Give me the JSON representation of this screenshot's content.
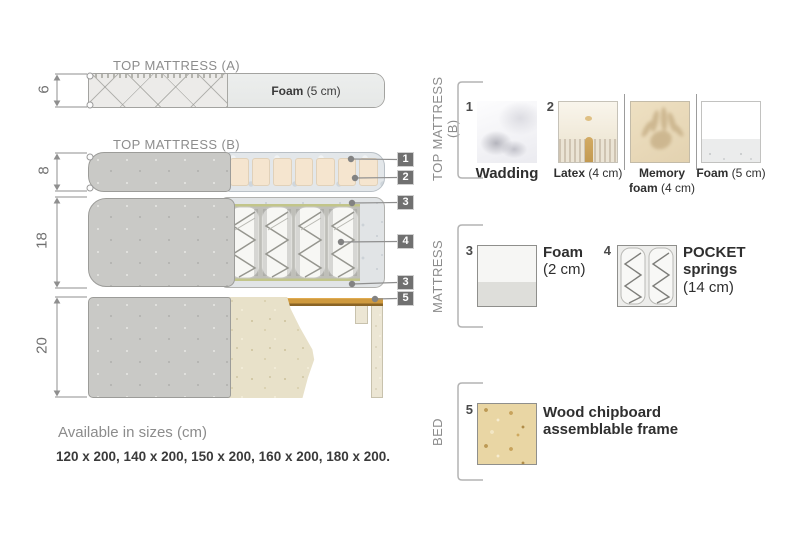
{
  "colors": {
    "badge_bg": "#707070",
    "wood_accent": "#cf9a3f",
    "text_dark": "#3a3a3a",
    "text_gray": "#8c8c8c",
    "cover_gray": "#c9c9c6",
    "bed_beige": "#e8e1c9",
    "block_cream": "#f5e5cf"
  },
  "diagram": {
    "top_mattress_a_title": "TOP MATTRESS (A)",
    "top_mattress_b_title": "TOP MATTRESS (B)",
    "foam_a": {
      "bold": "Foam",
      "rest": " (5 cm)"
    },
    "dims": [
      "6",
      "8",
      "18",
      "20"
    ],
    "badges": [
      "1",
      "2",
      "3",
      "4",
      "3",
      "5"
    ]
  },
  "legend": {
    "row1": {
      "section_label": "TOP MATTRESS (B)",
      "items": [
        {
          "num": "1",
          "bold": "Wadding",
          "rest": ""
        },
        {
          "num": "2",
          "bold": "Latex",
          "rest": " (4 cm)"
        },
        {
          "num": "",
          "bold": "Memory foam",
          "rest": " (4 cm)"
        },
        {
          "num": "",
          "bold": "Foam",
          "rest": " (5 cm)"
        }
      ]
    },
    "row2": {
      "section_label": "MATTRESS",
      "items": [
        {
          "num": "3",
          "bold": "Foam",
          "rest": "(2 cm)"
        },
        {
          "num": "4",
          "bold": "POCKET springs",
          "rest": "(14 cm)"
        }
      ]
    },
    "row3": {
      "section_label": "BED",
      "items": [
        {
          "num": "5",
          "bold": "Wood chipboard assemblable frame",
          "rest": ""
        }
      ]
    }
  },
  "footer": {
    "title": "Available in sizes (cm)",
    "sizes": "120 x 200, 140 x 200, 150 x 200, 160 x 200, 180 x 200."
  }
}
